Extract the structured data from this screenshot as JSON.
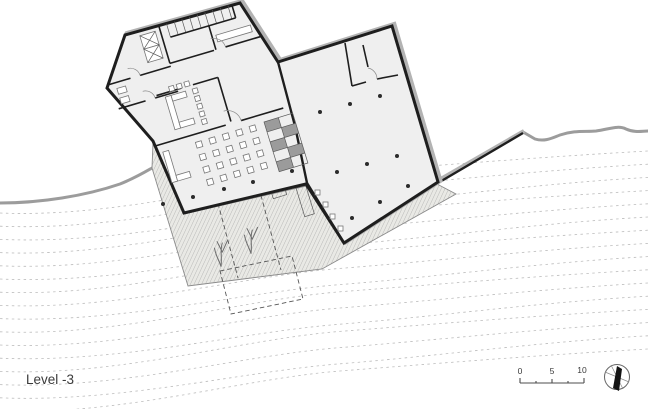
{
  "labels": {
    "level": "Level -3"
  },
  "scale_bar": {
    "tick_0": "0",
    "tick_5": "5",
    "tick_10": "10"
  },
  "icons": {
    "north_arrow": "compass-circle-with-needle"
  },
  "colors": {
    "background": "#ffffff",
    "wall": "#1e1e1e",
    "wall_shadow": "#b3b3b3",
    "floor_fill": "#efefef",
    "terrace_fill": "#e9e9e5",
    "hatch_line": "#9a9a9a",
    "terrain_line": "#9c9c9c",
    "contour_line": "#bcbcbc",
    "dashed_line": "#555555",
    "furniture_line": "#777777",
    "text": "#3a3a3a"
  }
}
